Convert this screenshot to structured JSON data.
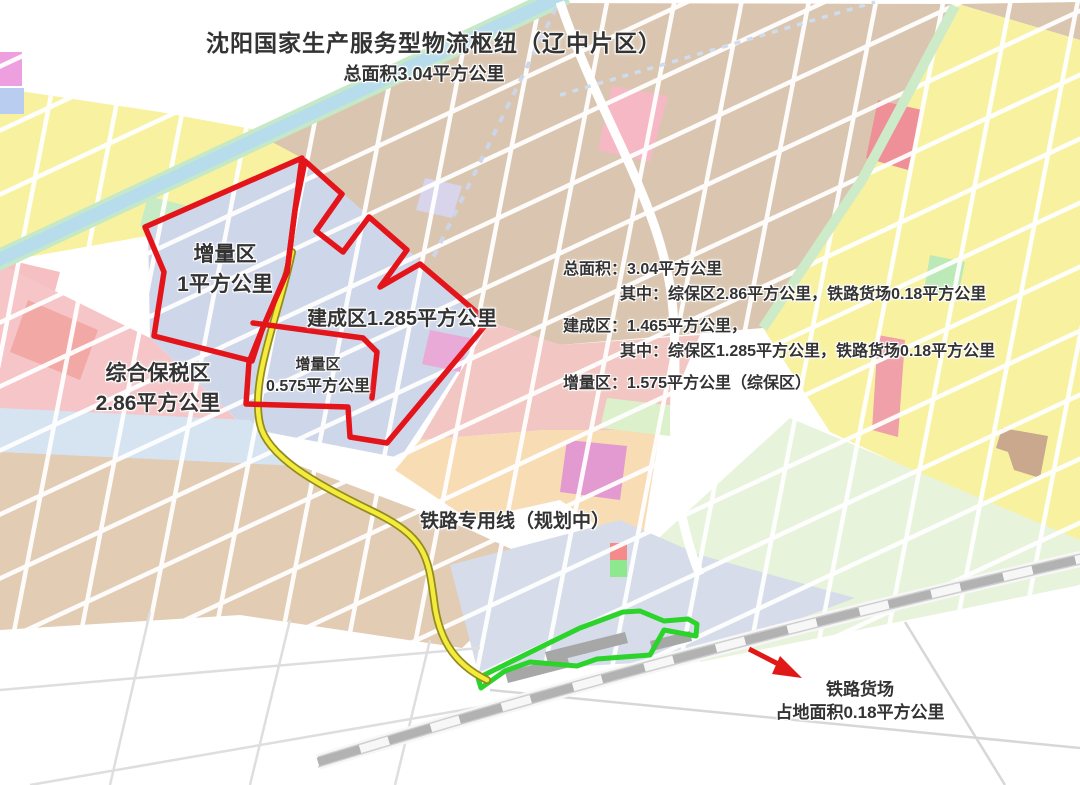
{
  "map": {
    "title": "沈阳国家生产服务型物流枢纽（辽中片区）",
    "subtitle": "总面积3.04平方公里",
    "zones": {
      "increment_west": {
        "name": "增量区",
        "area": "1平方公里"
      },
      "built": {
        "label": "建成区1.285平方公里"
      },
      "bonded": {
        "name": "综合保税区",
        "area": "2.86平方公里"
      },
      "increment_south": {
        "name": "增量区",
        "area": "0.575平方公里"
      }
    },
    "stats": {
      "total": "总面积：3.04平方公里",
      "total_detail": "其中：综保区2.86平方公里，铁路货场0.18平方公里",
      "built": "建成区：1.465平方公里，",
      "built_detail": "其中：综保区1.285平方公里，铁路货场0.18平方公里",
      "increment": "增量区：1.575平方公里（综保区）"
    },
    "rail_spur_label": "铁路专用线（规划中）",
    "freight_yard": {
      "name": "铁路货场",
      "area": "占地面积0.18平方公里"
    },
    "colors": {
      "boundary_red": "#e3151b",
      "rail_spur_yellow": "#f4ec3c",
      "rail_spur_outline": "#938b1c",
      "freight_yard_green": "#2bd32b",
      "railway_gray": "#b2b2b2",
      "arrow_red": "#e01818"
    }
  }
}
